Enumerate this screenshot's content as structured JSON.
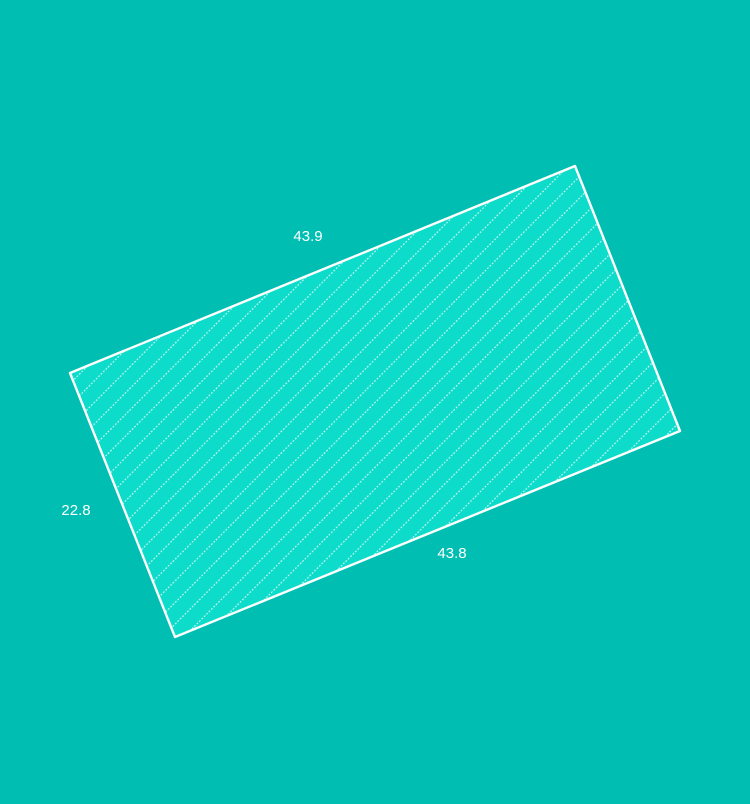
{
  "figure": {
    "description": "Rotated hatched rectangle parcel with dimension labels",
    "background_color": "#00bfb2",
    "shape": {
      "type": "rotated-rectangle",
      "points": "70,373 575,166 680,431 175,637",
      "fill_color": "#0ddcca",
      "stroke_color": "#ffffff",
      "stroke_width": "2.4",
      "hatch_color": "#ffffff",
      "hatch_style": "dotted-diagonal-45deg"
    },
    "labels": [
      {
        "text": "43.9",
        "x": "308",
        "y": "241",
        "edge": "top"
      },
      {
        "text": "22.8",
        "x": "76",
        "y": "515",
        "edge": "left"
      },
      {
        "text": "43.8",
        "x": "452",
        "y": "558",
        "edge": "bottom"
      }
    ],
    "label_color": "#ffffff"
  }
}
